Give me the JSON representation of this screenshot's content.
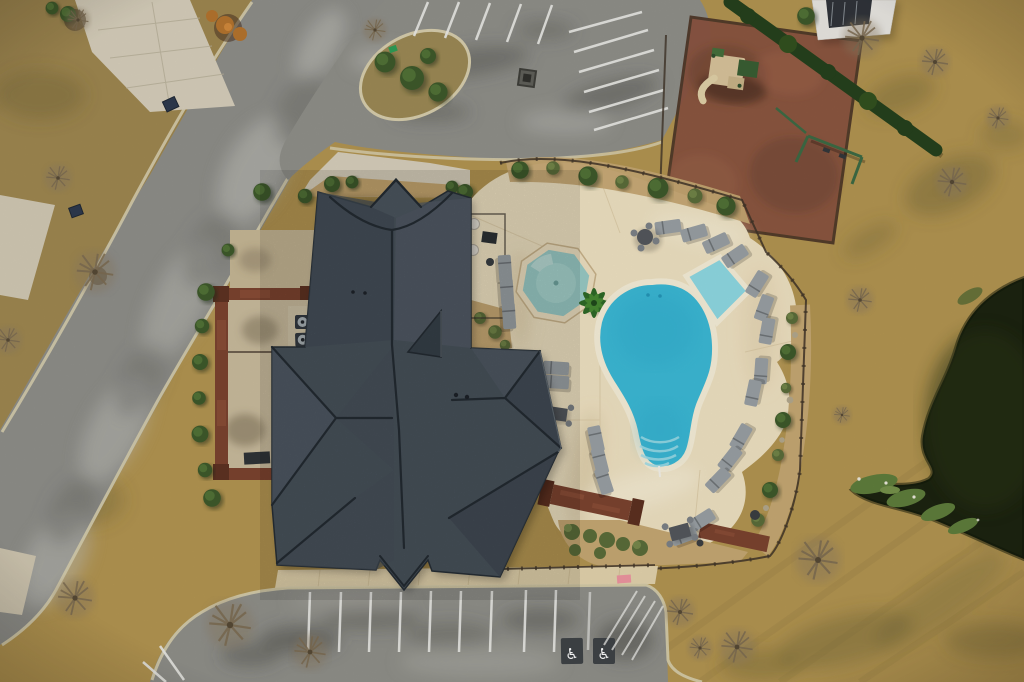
{
  "scene": {
    "type": "aerial-drone-photograph",
    "description": "Top-down winter aerial of a community clubhouse: charcoal hip roof, free-form pool with tanning ledge and steps, octagonal wading pool, cream pool deck with lounge chairs, fenced red-mulch playground with playset and swings, angled top parking lot, striped bottom parking lot with two accessible stalls, curving street, dormant tan lawns, bare trees and a dark pond.",
    "season": "winter - dormant tan grass, bare trees",
    "time_of_day": "daytime"
  },
  "counts": {
    "pools": 2,
    "lounge_chairs": 22,
    "patio_tables": 3,
    "hvac_units": 6,
    "top_parking_stripes": 11,
    "bottom_parking_stripes": 9,
    "bottom_left_angled_stripes": 2,
    "accessible_spaces": 2
  },
  "markings": {
    "accessible_symbol": "♿"
  },
  "colors": {
    "grass_base": "#b39551",
    "grass_left": "#9f8750",
    "grass_patch_dark": "#6e6434",
    "road_asphalt": "#8f8f8a",
    "road_worn": "#c4c3bd",
    "curb": "#d8cfae",
    "parking_asphalt": "#90908a",
    "stripe_white": "#ecece8",
    "concrete_walk": "#d7cfbb",
    "sidewalk": "#e3d3ad",
    "deck": "#efe2c2",
    "deck_shadow": "#c9b48c",
    "pool_water": "#3cb9d6",
    "pool_ledge": "#8fd9e3",
    "pool_coping": "#f6eed8",
    "pool_steps": "#9fdde8",
    "kiddie_pool": "#98c9c4",
    "pond": "#1c2410",
    "pond_grass": "#5f7e3c",
    "roof": "#4b555f",
    "roof_ridge": "#272e35",
    "brick": "#7c432f",
    "mulch": "#8b5541",
    "gravel": "#c6a873",
    "hedge": "#26411d",
    "shrub": "#3e5a2b",
    "palm": "#2e6a27",
    "furniture": "#9aa0a4",
    "table_dark": "#54585d",
    "house_body": "#e9e7e2",
    "house_roof": "#30343a",
    "play_equipment": "#3d6b45",
    "slide_tan": "#d9c49c",
    "pink_mark": "#ef8fa0",
    "hvac": "#343a40",
    "fence": "#403428",
    "bin_navy": "#2e3a4e",
    "sign_green": "#2f9e57",
    "autumn_orange": "#b5742e"
  }
}
